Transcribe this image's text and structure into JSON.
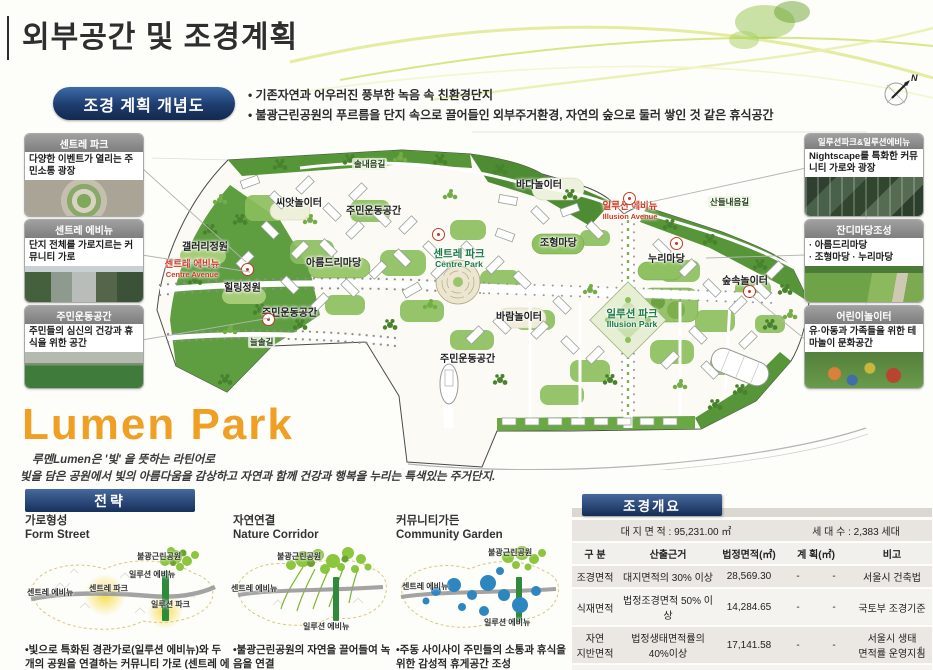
{
  "page": {
    "title": "외부공간 및 조경계획",
    "page_number": "1"
  },
  "concept": {
    "badge": "조경 계획 개념도",
    "bullet1": "• 기존자연과 어우러진 풍부한 녹음 속 친환경단지",
    "bullet2": "• 불광근린공원의 푸르름을 단지 속으로 끌어들인 외부주거환경, 자연의 숲으로 둘러 쌓인 것 같은 휴식공간"
  },
  "compass": {
    "label": "N"
  },
  "callouts": {
    "left": [
      {
        "title": "센트레 파크",
        "desc": "다양한 이벤트가 열리는 주민소통 광장"
      },
      {
        "title": "센트레 에비뉴",
        "desc": "단지 전체를 가로지르는 커뮤니티 가로"
      },
      {
        "title": "주민운동공간",
        "desc": "주민들의 심신의 건강과 휴식을 위한 공간"
      }
    ],
    "right": [
      {
        "title": "일루션파크&일루션에비뉴",
        "desc": "Nightscape를 특화한 커뮤니티 가로와 광장"
      },
      {
        "title": "잔디마당조성",
        "desc": "· 아름드리마당\n· 조형마당 · 누리마당"
      },
      {
        "title": "어린이놀이터",
        "desc": "유·아동과 가족들을 위한 테마놀이 문화공간"
      }
    ]
  },
  "map": {
    "labels": [
      {
        "text": "솔내음길"
      },
      {
        "text": "씨앗놀이터"
      },
      {
        "text": "주민운동공간"
      },
      {
        "text": "갤러리정원"
      },
      {
        "text": "아름드리마당"
      },
      {
        "text": "센트레 에비뉴",
        "en": "Centre Avenue"
      },
      {
        "text": "힐링정원"
      },
      {
        "text": "센트레 파크",
        "en": "Centre Park"
      },
      {
        "text": "바다놀이터"
      },
      {
        "text": "일루션 에비뉴",
        "en": "Illusion Avenue"
      },
      {
        "text": "산들내음길"
      },
      {
        "text": "조형마당"
      },
      {
        "text": "누리마당"
      },
      {
        "text": "숲속놀이터"
      },
      {
        "text": "바람놀이터"
      },
      {
        "text": "일루션 파크",
        "en": "Illusion Park"
      },
      {
        "text": "주민운동공간"
      },
      {
        "text": "늘솔길"
      },
      {
        "text": "주민운동공간"
      }
    ]
  },
  "lumen": {
    "title": "Lumen Park",
    "note1": "루멘Lumen은 '빛' 을 뜻하는 라틴어로",
    "note2": "빛을 담은 공원에서 빛의 아름다움을 감상하고 자연과 함께 건강과 행복을 누리는 특색있는 주거단지."
  },
  "strategy": {
    "header": "전략",
    "items": [
      {
        "title": "가로형성",
        "subtitle": "Form Street",
        "caption": "•빛으로 특화된 경관가로(일루션 에비뉴)와 두 개의 공원을 연결하는 커뮤니티 가로 (센트레 에비뉴)",
        "labels": [
          "불광근린공원",
          "일루션 에비뉴",
          "센트레 에비뉴",
          "센트레\n파크",
          "일루션\n파크"
        ]
      },
      {
        "title": "자연연결",
        "subtitle": "Nature Corridor",
        "caption": "•불광근린공원의 자연을 끌어들여 녹음을 연결",
        "labels": [
          "불광근린공원",
          "센트레 에비뉴",
          "일루션 에비뉴"
        ]
      },
      {
        "title": "커뮤니티가든",
        "subtitle": "Community Garden",
        "caption": "•주동 사이사이 주민들의 소통과 휴식을 위한 감성적 휴게공간 조성",
        "labels": [
          "불광근린공원",
          "센트레 에비뉴",
          "일루션 에비뉴"
        ]
      }
    ]
  },
  "overview": {
    "header": "조경개요",
    "site_area": "대 지 면 적 :  95,231.00 ㎡",
    "households": "세 대 수 : 2,383 세대",
    "columns": [
      "구  분",
      "산출근거",
      "법정면적(㎡)",
      "계  획(㎡)",
      "비고"
    ],
    "rows": [
      {
        "cat": "조경면적",
        "basis": "대지면적의 30% 이상",
        "legal": "28,569.30",
        "d1": "-",
        "d2": "-",
        "note": "서울시 건축법"
      },
      {
        "cat": "식재면적",
        "basis": "법정조경면적 50% 이상",
        "legal": "14,284.65",
        "d1": "-",
        "d2": "-",
        "note": "국토부 조경기준"
      },
      {
        "cat": "자연\n지반면적",
        "basis": "법정생태면적률의\n40%이상",
        "legal": "17,141.58",
        "d1": "-",
        "d2": "-",
        "note": "서울시 생태\n면적률 운영지침"
      },
      {
        "cat": "생태면적률",
        "basis": "대지면적의 45% 이상",
        "legal": "42,853.95",
        "d1": "-",
        "d2": "-",
        "note": "서울시 생태면적률\n운영지침"
      }
    ]
  },
  "colors": {
    "accent_navy": "#1d3c6e",
    "accent_orange": "#f09f25",
    "map_green": "#5e9d40",
    "marker_red": "#c23b22"
  }
}
